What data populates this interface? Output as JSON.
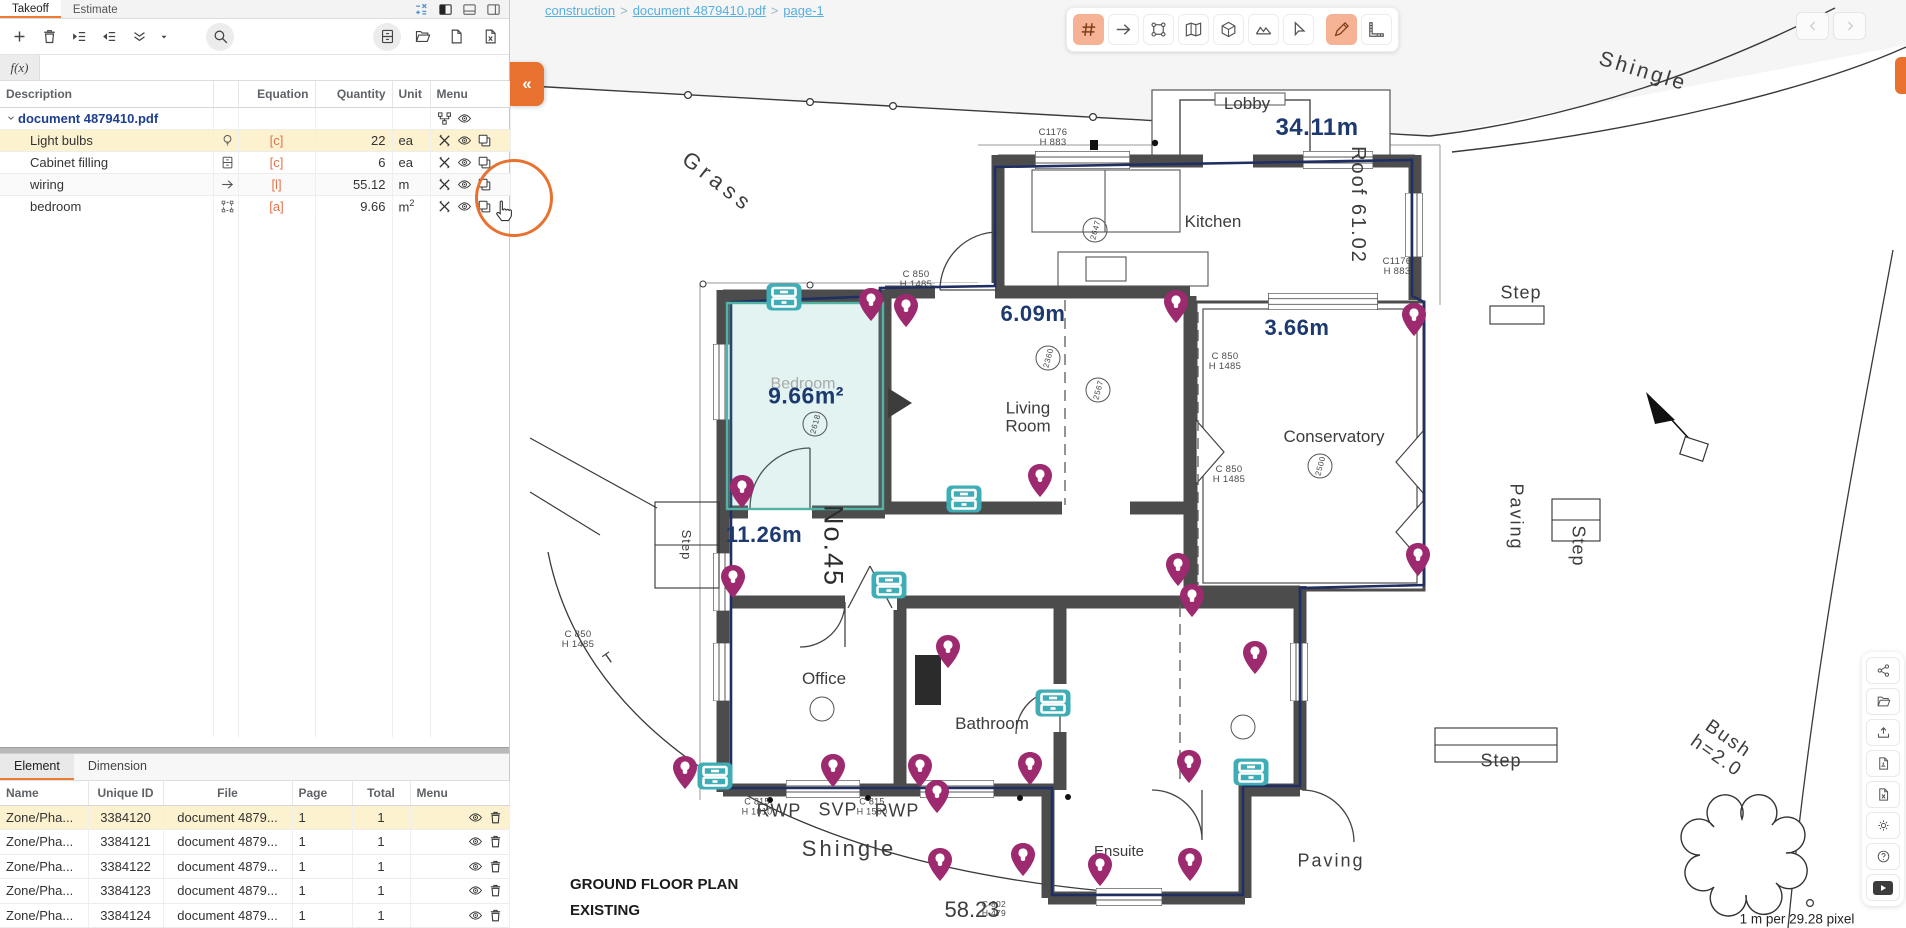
{
  "left_panel": {
    "tabs": [
      {
        "label": "Takeoff",
        "active": true
      },
      {
        "label": "Estimate",
        "active": false
      }
    ],
    "fx_label": "f(x)",
    "icon_names": [
      "add",
      "delete",
      "indent",
      "outdent",
      "collapse-all",
      "dropdown",
      "search",
      "cabinet",
      "folder-open",
      "new-file",
      "export-file",
      "calculator",
      "layout-left",
      "layout-bottom",
      "layout-right"
    ],
    "table": {
      "headers": {
        "description": "Description",
        "equation": "Equation",
        "quantity": "Quantity",
        "unit": "Unit",
        "menu": "Menu"
      },
      "rows": [
        {
          "description": "document 4879410.pdf",
          "equation": "",
          "quantity": "",
          "unit": "",
          "unit_sup": ""
        },
        {
          "description": "Light bulbs",
          "icon": "bulb",
          "equation": "[c]",
          "quantity": "22",
          "unit": "ea",
          "unit_sup": ""
        },
        {
          "description": "Cabinet filling",
          "icon": "cabinet",
          "equation": "[c]",
          "quantity": "6",
          "unit": "ea",
          "unit_sup": ""
        },
        {
          "description": "wiring",
          "icon": "arrow",
          "equation": "[l]",
          "quantity": "55.12",
          "unit": "m",
          "unit_sup": ""
        },
        {
          "description": "bedroom",
          "icon": "area",
          "equation": "[a]",
          "quantity": "9.66",
          "unit": "m",
          "unit_sup": "2"
        }
      ]
    },
    "bottom_tabs": [
      {
        "label": "Element",
        "active": true
      },
      {
        "label": "Dimension",
        "active": false
      }
    ],
    "element_table": {
      "headers": {
        "name": "Name",
        "id": "Unique ID",
        "file": "File",
        "page": "Page",
        "total": "Total",
        "menu": "Menu"
      },
      "rows": [
        {
          "name": "Zone/Pha...",
          "id": "3384120",
          "file": "document 4879...",
          "page": "1",
          "total": "1"
        },
        {
          "name": "Zone/Pha...",
          "id": "3384121",
          "file": "document 4879...",
          "page": "1",
          "total": "1"
        },
        {
          "name": "Zone/Pha...",
          "id": "3384122",
          "file": "document 4879...",
          "page": "1",
          "total": "1"
        },
        {
          "name": "Zone/Pha...",
          "id": "3384123",
          "file": "document 4879...",
          "page": "1",
          "total": "1"
        },
        {
          "name": "Zone/Pha...",
          "id": "3384124",
          "file": "document 4879...",
          "page": "1",
          "total": "1"
        }
      ]
    },
    "collapse_label": "«"
  },
  "breadcrumb": {
    "items": [
      "construction",
      "document 4879410.pdf",
      "page-1"
    ],
    "separator": ">"
  },
  "tool_palette": [
    "count-hash",
    "arrow-line",
    "polygon-area",
    "map",
    "cube-3d",
    "surface",
    "select-cursor",
    "pencil-markup",
    "ruler-scale"
  ],
  "right_rail_icons": [
    "share",
    "folder-open",
    "upload",
    "pdf-export",
    "excel-export",
    "settings",
    "help",
    "youtube"
  ],
  "colors": {
    "accent_orange": "#e8712f",
    "selection_yellow": "#fdf2d0",
    "pin_magenta": "#9d2a6e",
    "marker_teal": "#3fadb5",
    "measure_navy": "#1d3a70",
    "equation_orange": "#e2734c",
    "link_blue": "#58aede"
  },
  "plan": {
    "room_highlight": {
      "x": 727,
      "y": 303,
      "w": 156,
      "h": 206
    },
    "pins": [
      [
        871,
        308
      ],
      [
        906,
        314
      ],
      [
        1176,
        310
      ],
      [
        1414,
        323
      ],
      [
        742,
        495
      ],
      [
        1040,
        484
      ],
      [
        733,
        585
      ],
      [
        1178,
        573
      ],
      [
        1192,
        604
      ],
      [
        1418,
        563
      ],
      [
        948,
        655
      ],
      [
        1255,
        661
      ],
      [
        685,
        776
      ],
      [
        833,
        774
      ],
      [
        920,
        774
      ],
      [
        1030,
        772
      ],
      [
        1189,
        770
      ],
      [
        937,
        800
      ],
      [
        940,
        868
      ],
      [
        1023,
        863
      ],
      [
        1100,
        873
      ],
      [
        1190,
        868
      ]
    ],
    "cabinets": [
      [
        784,
        297
      ],
      [
        964,
        499
      ],
      [
        889,
        585
      ],
      [
        1053,
        703
      ],
      [
        715,
        776
      ],
      [
        1251,
        772
      ]
    ],
    "circles": [
      {
        "x": 1095,
        "y": 230,
        "v": "2647"
      },
      {
        "x": 1048,
        "y": 358,
        "v": "2360"
      },
      {
        "x": 1098,
        "y": 390,
        "v": "2567"
      },
      {
        "x": 815,
        "y": 424,
        "v": "2618"
      },
      {
        "x": 1320,
        "y": 466,
        "v": "2500"
      },
      {
        "x": 822,
        "y": 709,
        "v": ""
      },
      {
        "x": 1243,
        "y": 727,
        "v": ""
      }
    ],
    "labels": [
      {
        "t": "Grass",
        "x": 718,
        "y": 182,
        "s": 22,
        "rot": 38,
        "sp": 5,
        "cls": "plan"
      },
      {
        "t": "Lobby",
        "x": 1247,
        "y": 104,
        "s": 17,
        "cls": "plan"
      },
      {
        "t": "34.11m",
        "x": 1317,
        "y": 128,
        "s": 24,
        "cls": "navy"
      },
      {
        "t": "Kitchen",
        "x": 1213,
        "y": 222,
        "s": 17,
        "cls": "plan"
      },
      {
        "t": "C1176\nH 883",
        "x": 1053,
        "y": 138,
        "s": 9.5,
        "cls": "tiny"
      },
      {
        "t": "C1176\nH 883",
        "x": 1397,
        "y": 267,
        "s": 9.5,
        "cls": "tiny"
      },
      {
        "t": "Roof 61.02",
        "x": 1357,
        "y": 205,
        "s": 20,
        "rot": 90,
        "sp": 2,
        "cls": "plan"
      },
      {
        "t": "Shingle",
        "x": 1643,
        "y": 72,
        "s": 21,
        "rot": 17,
        "sp": 3,
        "cls": "plan"
      },
      {
        "t": "Step",
        "x": 1521,
        "y": 293,
        "s": 18,
        "sp": 1,
        "cls": "plan"
      },
      {
        "t": "6.09m",
        "x": 1033,
        "y": 314,
        "s": 22,
        "cls": "navy"
      },
      {
        "t": "3.66m",
        "x": 1297,
        "y": 328,
        "s": 22,
        "cls": "navy"
      },
      {
        "t": "C 850\nH 1485",
        "x": 916,
        "y": 280,
        "s": 9.5,
        "cls": "tiny"
      },
      {
        "t": "C 850\nH 1485",
        "x": 1225,
        "y": 362,
        "s": 9.5,
        "cls": "tiny"
      },
      {
        "t": "C 850\nH 1485",
        "x": 1229,
        "y": 475,
        "s": 9.5,
        "cls": "tiny"
      },
      {
        "t": "C 850\nH 1485",
        "x": 578,
        "y": 640,
        "s": 9.5,
        "cls": "tiny"
      },
      {
        "t": "Bedroom",
        "x": 803,
        "y": 384,
        "s": 16,
        "cls": "plan-faint"
      },
      {
        "t": "9.66m²",
        "x": 806,
        "y": 396,
        "s": 23,
        "cls": "navy"
      },
      {
        "t": "Living\nRoom",
        "x": 1028,
        "y": 418,
        "s": 17,
        "cls": "plan"
      },
      {
        "t": "Conservatory",
        "x": 1334,
        "y": 437,
        "s": 17,
        "cls": "plan"
      },
      {
        "t": "No.45",
        "x": 833,
        "y": 546,
        "s": 27,
        "rot": 90,
        "sp": 2,
        "cls": "plan-dark"
      },
      {
        "t": "11.26m",
        "x": 764,
        "y": 535,
        "s": 22,
        "cls": "navy"
      },
      {
        "t": "Paving",
        "x": 1516,
        "y": 517,
        "s": 18,
        "rot": 90,
        "sp": 2,
        "cls": "plan"
      },
      {
        "t": "Step",
        "x": 1578,
        "y": 546,
        "s": 18,
        "rot": 90,
        "sp": 1,
        "cls": "plan"
      },
      {
        "t": "Step",
        "x": 686,
        "y": 545,
        "s": 13,
        "rot": 90,
        "sp": 1,
        "cls": "plan"
      },
      {
        "t": "Office",
        "x": 824,
        "y": 679,
        "s": 17,
        "cls": "plan"
      },
      {
        "t": "Bathroom",
        "x": 992,
        "y": 724,
        "s": 17,
        "cls": "plan"
      },
      {
        "t": "Step",
        "x": 1501,
        "y": 761,
        "s": 18,
        "sp": 1,
        "cls": "plan"
      },
      {
        "t": "RWP",
        "x": 779,
        "y": 811,
        "s": 18,
        "sp": 1,
        "cls": "plan"
      },
      {
        "t": "SVP",
        "x": 838,
        "y": 810,
        "s": 18,
        "sp": 1,
        "cls": "plan"
      },
      {
        "t": "RWP",
        "x": 897,
        "y": 811,
        "s": 18,
        "sp": 1,
        "cls": "plan"
      },
      {
        "t": "C 815\nH 1010",
        "x": 757,
        "y": 807,
        "s": 9,
        "cls": "tiny"
      },
      {
        "t": "C 815\nH 1500",
        "x": 872,
        "y": 807,
        "s": 9,
        "cls": "tiny"
      },
      {
        "t": "Shingle",
        "x": 849,
        "y": 849,
        "s": 22,
        "sp": 3,
        "cls": "plan"
      },
      {
        "t": "Ensuite",
        "x": 1119,
        "y": 852,
        "s": 15,
        "cls": "plan"
      },
      {
        "t": "Paving",
        "x": 1331,
        "y": 861,
        "s": 18,
        "sp": 2,
        "cls": "plan"
      },
      {
        "t": "GROUND FLOOR PLAN\nEXISTING",
        "x": 570,
        "y": 898,
        "s": 15,
        "cls": "print",
        "anchor": "left"
      },
      {
        "t": "58.23",
        "x": 972,
        "y": 910,
        "s": 22,
        "cls": "plan"
      },
      {
        "t": "C 802\nH 479",
        "x": 994,
        "y": 909,
        "s": 8.5,
        "cls": "tiny"
      },
      {
        "t": "Bush\nh=2.0",
        "x": 1722,
        "y": 748,
        "s": 19,
        "rot": 35,
        "sp": 2,
        "cls": "plan"
      },
      {
        "t": "T",
        "x": 609,
        "y": 659,
        "s": 15,
        "rot": -35,
        "cls": "plan"
      },
      {
        "t": "1 m per 29.28 pixel",
        "x": 1797,
        "y": 920,
        "s": 13.5,
        "cls": "scale"
      }
    ]
  }
}
